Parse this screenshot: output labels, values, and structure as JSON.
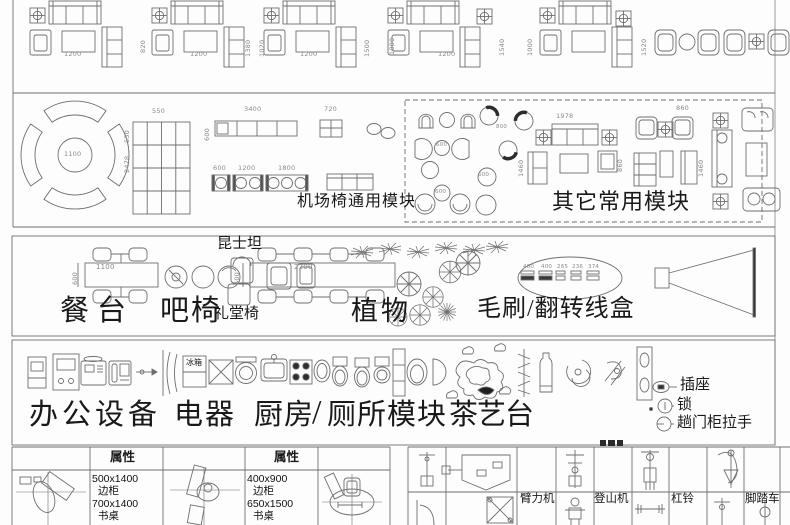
{
  "colors": {
    "background": "#fdfdfd",
    "line": "#6f6f6f",
    "text": "#191919",
    "dim_text": "#8a8a8a",
    "dark_fill": "#2e2e2e"
  },
  "sofa_band": {
    "dims": [
      "1200",
      "820",
      "1200",
      "1380",
      "1020",
      "1200",
      "1500",
      "1080",
      "1200",
      "1540",
      "1000",
      "1520"
    ]
  },
  "airport_band": {
    "circle_diameter": "1100",
    "circle_height": "2478",
    "grid_w": "550",
    "grid_h": "550",
    "bench_length": "3400",
    "bench_depth": "600",
    "seat_width": "720",
    "bench_dims": [
      "600",
      "1200",
      "1800"
    ],
    "label": "机场椅通用模块"
  },
  "misc_band": {
    "label": "其它常用模块",
    "chair_dims": {
      "c600_1": "600",
      "c800": "800",
      "c600_2": "600",
      "c600_3": "600"
    },
    "sofa_dims": {
      "w1978": "1978",
      "w860_1": "860",
      "h1460_1": "1460",
      "h860_2": "860",
      "h1460_2": "1460"
    }
  },
  "dining_band": {
    "table1_w": "1100",
    "table1_d": "600",
    "table2_w": "2200",
    "table2_d": "600",
    "label_dining": "餐台",
    "label_bar": "吧椅",
    "label_kunshitan": "昆士坦",
    "label_auditorium": "礼堂椅",
    "label_plants": "植物",
    "label_brush": "毛刷/翻转线盒",
    "brush_dims": [
      "400",
      "400",
      "265",
      "236",
      "374"
    ]
  },
  "office_band": {
    "label_office": "办公设备",
    "label_appliance": "电器",
    "label_kitchen": "厨房",
    "slash": "/",
    "label_wc": "厕所模块",
    "label_tea": "茶艺台",
    "fridge": "冰箱",
    "legend": [
      "插座",
      "锁",
      "趟门柜拉手"
    ]
  },
  "bottom_band": {
    "property_header_1": "属性",
    "property_header_2": "属性",
    "cell1_lines": [
      "500x1400",
      "边柜",
      "700x1400",
      "书桌"
    ],
    "cell2_lines": [
      "400x900",
      "边柜",
      "650x1500",
      "书桌"
    ],
    "gym_labels": [
      "臂力机",
      "登山机",
      "杠铃",
      "脚踏车"
    ]
  }
}
